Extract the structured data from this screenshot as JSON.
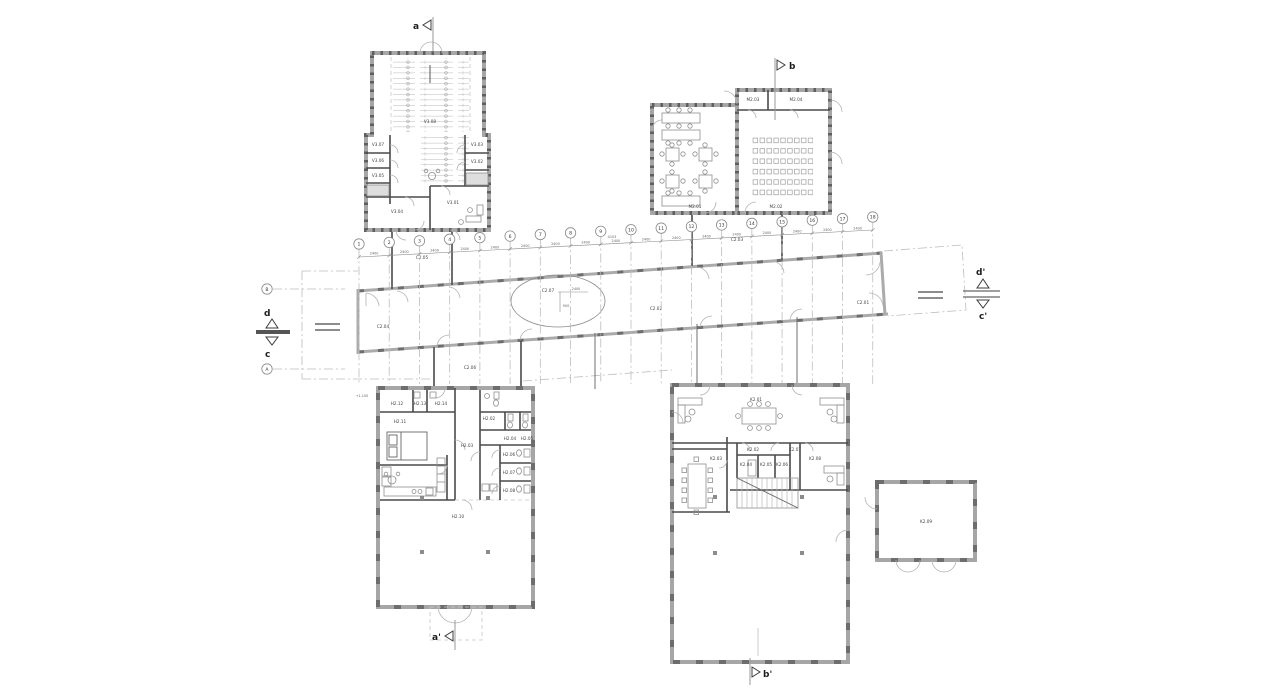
{
  "sections": {
    "a": "a",
    "a_prime": "a'",
    "b": "b",
    "b_prime": "b'",
    "c": "c",
    "c_prime": "c'",
    "d": "d",
    "d_prime": "d'"
  },
  "grid": {
    "letters": {
      "a": "A",
      "b": "B"
    },
    "numbers": [
      "1",
      "2",
      "3",
      "4",
      "5",
      "6",
      "7",
      "8",
      "9",
      "10",
      "11",
      "12",
      "13",
      "14",
      "15",
      "16",
      "17",
      "18"
    ],
    "bay_dim": "2400",
    "bay_dim_wide": "4103"
  },
  "levels": {
    "entry": "+1.100"
  },
  "dims": {
    "ellipse_w": "2400",
    "ellipse_h": "900"
  },
  "rooms": {
    "dormitory": {
      "v301": "V3.01",
      "v302": "V3.02",
      "v303": "V3.03",
      "v304": "V3.04",
      "v305": "V3.05",
      "v306": "V3.06",
      "v307": "V3.07",
      "v308": "V3.08"
    },
    "dining": {
      "m201": "M2.01",
      "m202": "M2.02",
      "m203": "M2.03",
      "m204": "M2.04"
    },
    "corridor": {
      "c201": "C2.01",
      "c202": "C2.02",
      "c203": "C2.03",
      "c204": "C2.04",
      "c205": "C2.05",
      "c206": "C2.06",
      "c207": "C2.07"
    },
    "house": {
      "h202": "H2.02",
      "h203": "H2.03",
      "h204": "H2.04",
      "h205": "H2.05",
      "h206": "H2.06",
      "h207": "H2.07",
      "h208": "H2.08",
      "h210": "H2.10",
      "h211": "H2.11",
      "h212": "H2.12",
      "h213": "H2.13",
      "h214": "H2.14"
    },
    "office": {
      "k201": "K2.01",
      "k202": "K2.02",
      "k203": "K2.03",
      "k204": "K2.04",
      "k205": "K2.05",
      "k206": "K2.06",
      "k207": "K2.07",
      "k208": "K2.08"
    },
    "shed": {
      "k209": "K2.09"
    }
  }
}
